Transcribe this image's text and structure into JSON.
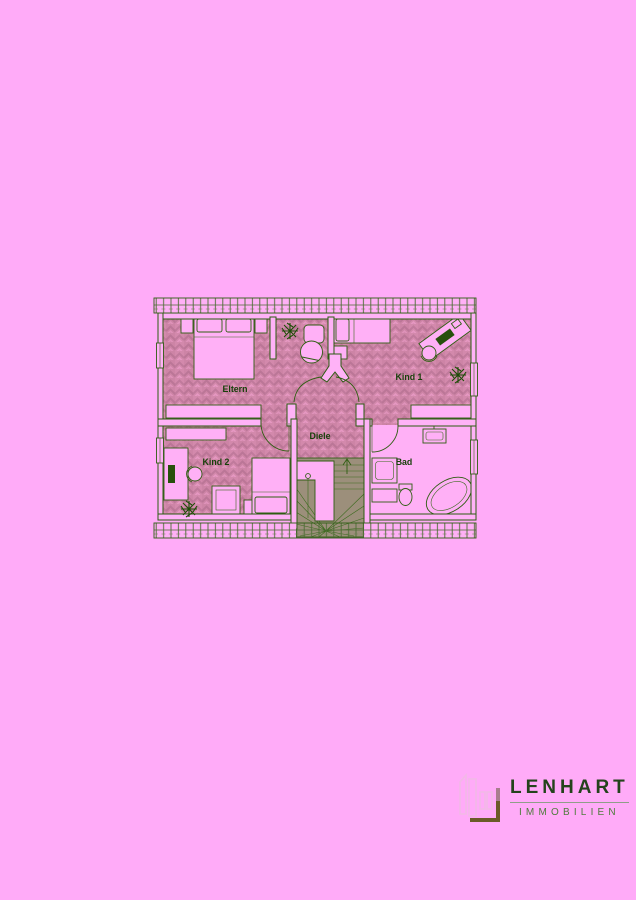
{
  "page": {
    "background_color": "#ffabf8"
  },
  "floorplan": {
    "room_labels": {
      "eltern": "Eltern",
      "kind1": "Kind 1",
      "kind2": "Kind 2",
      "diele": "Diele",
      "bad": "Bad"
    },
    "colors": {
      "wall_line": "#2b5c10",
      "label_text": "#17400a",
      "wall_fill": "#ffb2f7",
      "parquet_base": "#d389ac",
      "parquet_dark": "#c07a9c",
      "parquet_light": "#e698c2",
      "stair_area": "#9c8f7b"
    }
  },
  "logo": {
    "brand": "LENHART",
    "tagline": "IMMOBILIEN",
    "colors": {
      "brand_text": "#24431c",
      "tagline_text": "#4e7c3c",
      "mark_outline": "#f2b9e6",
      "mark_accent": "#6b5a28"
    }
  }
}
